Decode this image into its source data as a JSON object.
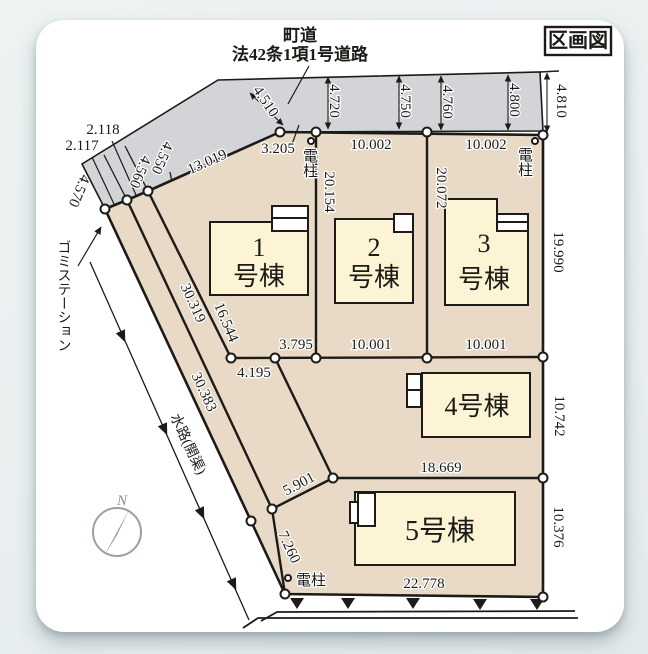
{
  "page": {
    "title": "区画図"
  },
  "road": {
    "name_line1": "町道",
    "name_line2": "法42条1項1号道路"
  },
  "dims": {
    "road_w1": "4.510",
    "road_w2": "4.720",
    "road_w3": "4.750",
    "road_w4": "4.760",
    "road_w5": "4.800",
    "road_w6": "4.810",
    "frontage_road": "13.019",
    "lot1_front": "3.205",
    "lot2_front": "10.002",
    "lot3_front": "10.002",
    "lot1_depth": "20.154",
    "lot2_depth": "20.072",
    "lot3_right": "19.990",
    "strip_a": "2.118",
    "strip_b": "2.117",
    "strip_c": "4.550",
    "strip_d": "4.560",
    "strip_e": "4.570",
    "lot1_west": "16.544",
    "west_inner": "30.319",
    "west_outer": "30.383",
    "mid_a": "3.795",
    "mid_b": "4.195",
    "lot2_bottom": "10.001",
    "lot3_bottom": "10.001",
    "lot4_right": "10.742",
    "lot45_line": "18.669",
    "lot5_west": "5.901",
    "sw_edge": "7.260",
    "lot5_right": "10.376",
    "south_edge": "22.778"
  },
  "buildings": {
    "b1_num": "1",
    "b1_suffix": "号棟",
    "b2_num": "2",
    "b2_suffix": "号棟",
    "b3_num": "3",
    "b3_suffix": "号棟",
    "b4_label": "4号棟",
    "b5_label": "5号棟"
  },
  "annotations": {
    "garbage_station": "ゴミステーション",
    "waterway": "水路(開渠)",
    "pole_top_left": "電柱",
    "pole_top_right": "電柱",
    "pole_bottom": "電柱",
    "north": "N"
  },
  "colors": {
    "road": "#d3d4d8",
    "parcel": "#e8dac6",
    "building": "#fcf4d4",
    "line": "#1c1b17",
    "card": "#ffffff"
  }
}
